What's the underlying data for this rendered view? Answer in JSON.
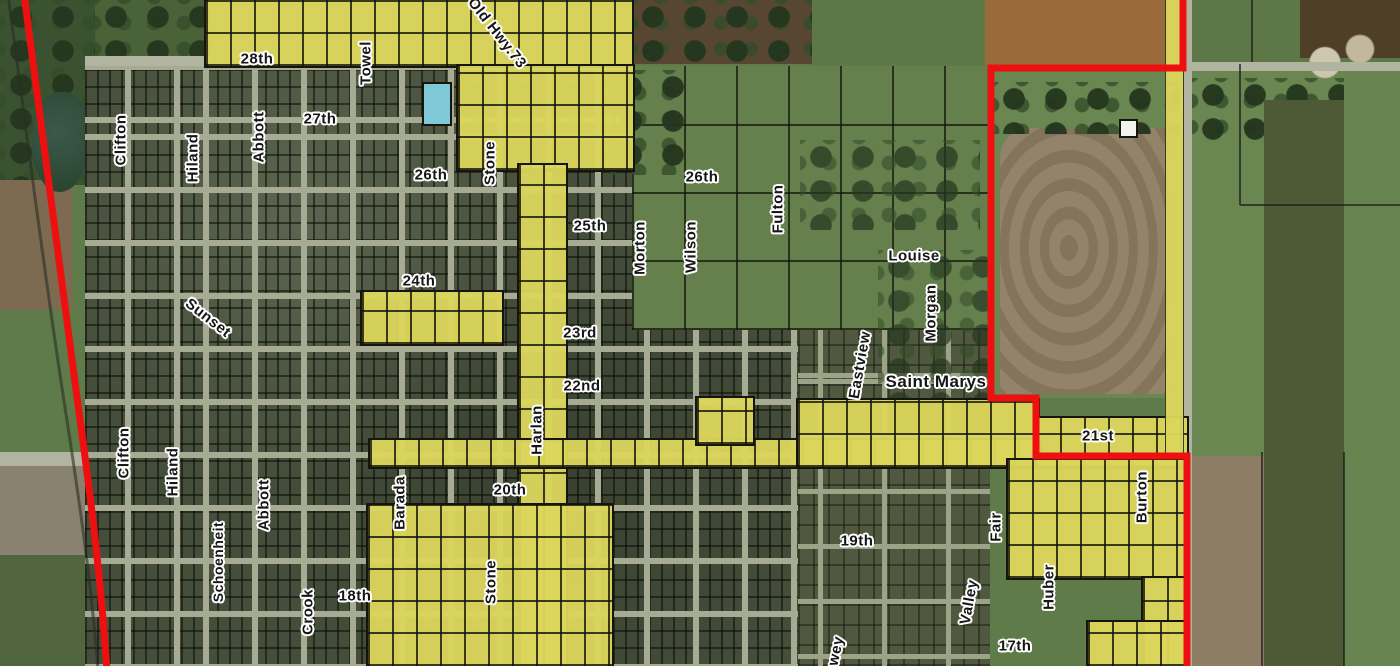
{
  "map": {
    "description_kind": "aerial parcel / zoning map",
    "colors": {
      "highlight_yellow": "#dbd55c",
      "boundary_red": "#ee1010",
      "parcel_line_black": "#15150d",
      "street_gray": "#a8ab93",
      "label_text": "#161616",
      "label_halo": "#ffffff"
    },
    "labels": [
      {
        "text": "28th",
        "x": 257,
        "y": 59,
        "rot": 0
      },
      {
        "text": "Towel",
        "x": 366,
        "y": 63,
        "rot": -90
      },
      {
        "text": "Old Hwy.73",
        "x": 497,
        "y": 33,
        "rot": 52
      },
      {
        "text": "Clifton",
        "x": 121,
        "y": 140,
        "rot": -90
      },
      {
        "text": "Hiland",
        "x": 193,
        "y": 158,
        "rot": -90
      },
      {
        "text": "Abbott",
        "x": 259,
        "y": 137,
        "rot": -90
      },
      {
        "text": "27th",
        "x": 320,
        "y": 119,
        "rot": 0
      },
      {
        "text": "26th",
        "x": 431,
        "y": 175,
        "rot": 0
      },
      {
        "text": "Stone",
        "x": 490,
        "y": 163,
        "rot": -90
      },
      {
        "text": "26th",
        "x": 702,
        "y": 177,
        "rot": 0
      },
      {
        "text": "25th",
        "x": 590,
        "y": 226,
        "rot": 0
      },
      {
        "text": "Morton",
        "x": 640,
        "y": 248,
        "rot": -90
      },
      {
        "text": "Wilson",
        "x": 691,
        "y": 247,
        "rot": -90
      },
      {
        "text": "Fulton",
        "x": 778,
        "y": 209,
        "rot": -90
      },
      {
        "text": "Louise",
        "x": 914,
        "y": 256,
        "rot": 0
      },
      {
        "text": "Morgan",
        "x": 931,
        "y": 313,
        "rot": -90
      },
      {
        "text": "Sunset",
        "x": 208,
        "y": 318,
        "rot": 38
      },
      {
        "text": "24th",
        "x": 419,
        "y": 281,
        "rot": 0
      },
      {
        "text": "23rd",
        "x": 580,
        "y": 333,
        "rot": 0
      },
      {
        "text": "22nd",
        "x": 582,
        "y": 386,
        "rot": 0
      },
      {
        "text": "Harlan",
        "x": 537,
        "y": 430,
        "rot": -90
      },
      {
        "text": "Eastview",
        "x": 860,
        "y": 365,
        "rot": -80
      },
      {
        "text": "Saint Marys",
        "x": 936,
        "y": 382,
        "rot": 0,
        "size": 17
      },
      {
        "text": "21st",
        "x": 1098,
        "y": 436,
        "rot": 0
      },
      {
        "text": "Clifton",
        "x": 124,
        "y": 453,
        "rot": -90
      },
      {
        "text": "Hiland",
        "x": 173,
        "y": 472,
        "rot": -90
      },
      {
        "text": "Abbott",
        "x": 264,
        "y": 505,
        "rot": -90
      },
      {
        "text": "Barada",
        "x": 400,
        "y": 503,
        "rot": -90
      },
      {
        "text": "20th",
        "x": 510,
        "y": 490,
        "rot": 0
      },
      {
        "text": "Schoenheit",
        "x": 218,
        "y": 562,
        "rot": -90,
        "size": 14
      },
      {
        "text": "Crook",
        "x": 308,
        "y": 612,
        "rot": -90
      },
      {
        "text": "18th",
        "x": 355,
        "y": 596,
        "rot": 0
      },
      {
        "text": "Stone",
        "x": 491,
        "y": 582,
        "rot": -90
      },
      {
        "text": "Fair",
        "x": 996,
        "y": 527,
        "rot": -90
      },
      {
        "text": "Burton",
        "x": 1142,
        "y": 497,
        "rot": -90
      },
      {
        "text": "19th",
        "x": 857,
        "y": 541,
        "rot": 0
      },
      {
        "text": "Valley",
        "x": 969,
        "y": 602,
        "rot": -80
      },
      {
        "text": "Huber",
        "x": 1049,
        "y": 587,
        "rot": -90
      },
      {
        "text": "17th",
        "x": 1015,
        "y": 646,
        "rot": 0
      },
      {
        "text": "wey",
        "x": 836,
        "y": 651,
        "rot": -78
      }
    ]
  }
}
